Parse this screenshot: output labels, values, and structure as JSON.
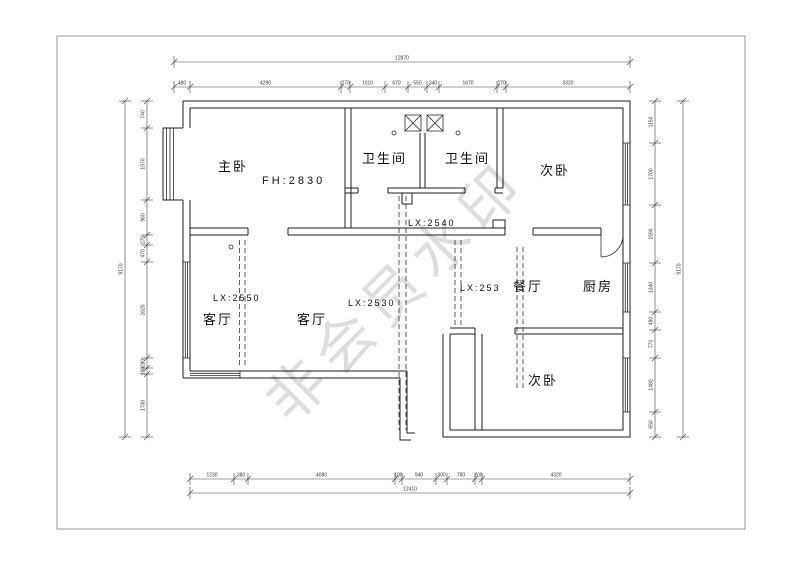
{
  "watermark": "非会员水印",
  "rooms": {
    "master": "主卧",
    "bath1": "卫生间",
    "bath2": "卫生间",
    "bed_top": "次卧",
    "living1": "客厅",
    "living2": "客厅",
    "dining": "餐厅",
    "kitchen": "厨房",
    "bed_bottom": "次卧"
  },
  "labels": {
    "fh": "FH:2830",
    "lx2540": "LX:2540",
    "lx2550": "LX:2550",
    "lx2530": "LX:2530",
    "lx253": "LX:253"
  },
  "dimension_chains": [
    {
      "name": "top-total",
      "orient": "h",
      "line": 62,
      "ticks": [
        174,
        630
      ],
      "values": [
        "12870"
      ]
    },
    {
      "name": "top-segments",
      "orient": "h",
      "line": 87,
      "ticks": [
        174,
        190,
        341,
        350,
        385,
        408,
        427,
        439,
        497,
        506,
        630
      ],
      "values": [
        "480",
        "4290",
        "270",
        "1010",
        "670",
        "550",
        "340",
        "1670",
        "270",
        "3320"
      ]
    },
    {
      "name": "bottom-segments",
      "orient": "h",
      "line": 479,
      "ticks": [
        190,
        234,
        248,
        395,
        402,
        436,
        447,
        475,
        482,
        630
      ],
      "values": [
        "1230",
        "380",
        "4080",
        "180",
        "940",
        "300",
        "780",
        "200",
        "4320"
      ]
    },
    {
      "name": "bottom-total",
      "orient": "h",
      "line": 493,
      "ticks": [
        190,
        630
      ],
      "values": [
        "12410"
      ]
    },
    {
      "name": "left-total",
      "orient": "v",
      "line": 125,
      "ticks": [
        101,
        437
      ],
      "values": [
        "9170"
      ]
    },
    {
      "name": "left-segments",
      "orient": "v",
      "line": 147,
      "ticks": [
        101,
        128,
        200,
        235,
        245,
        262,
        358,
        368,
        374,
        437
      ],
      "values": [
        "740",
        "1970",
        "960",
        "270",
        "470",
        "2620",
        "280",
        "160",
        "1700"
      ]
    },
    {
      "name": "right-segments",
      "orient": "v",
      "line": 655,
      "ticks": [
        101,
        143,
        205,
        263,
        312,
        330,
        358,
        412,
        437
      ],
      "values": [
        "1150",
        "1700",
        "1590",
        "1340",
        "490",
        "770",
        "1480",
        "650"
      ]
    },
    {
      "name": "right-total",
      "orient": "v",
      "line": 683,
      "ticks": [
        101,
        437
      ],
      "values": [
        "9170"
      ]
    }
  ],
  "colors": {
    "wall": "#1c1c1c",
    "dimension": "#444444",
    "watermark_gray": "#d9d9d9",
    "border": "#999999"
  }
}
